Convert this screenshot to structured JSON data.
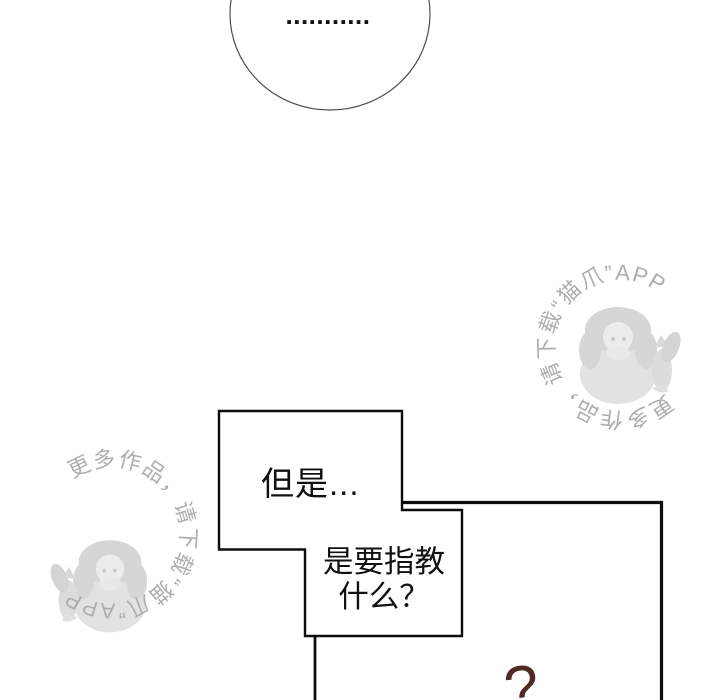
{
  "page": {
    "background": "#ffffff"
  },
  "thought_bubble": {
    "dots": "..........."
  },
  "dialogue": {
    "bubble_a_text": "但是...",
    "bubble_b_line1": "是要指教",
    "bubble_b_line2": "什么？"
  },
  "sfx": {
    "question_mark": "?",
    "color": "#4f2b26"
  },
  "watermark": {
    "text": "更多作品，请下载“猫爪”APP",
    "color": "#aeaeae"
  },
  "panel": {
    "line_color": "#0d0d0d"
  },
  "bubble_style": {
    "stroke": "#0d0d0d",
    "fill": "#ffffff",
    "ellipse_stroke": "#4d4d4d"
  }
}
